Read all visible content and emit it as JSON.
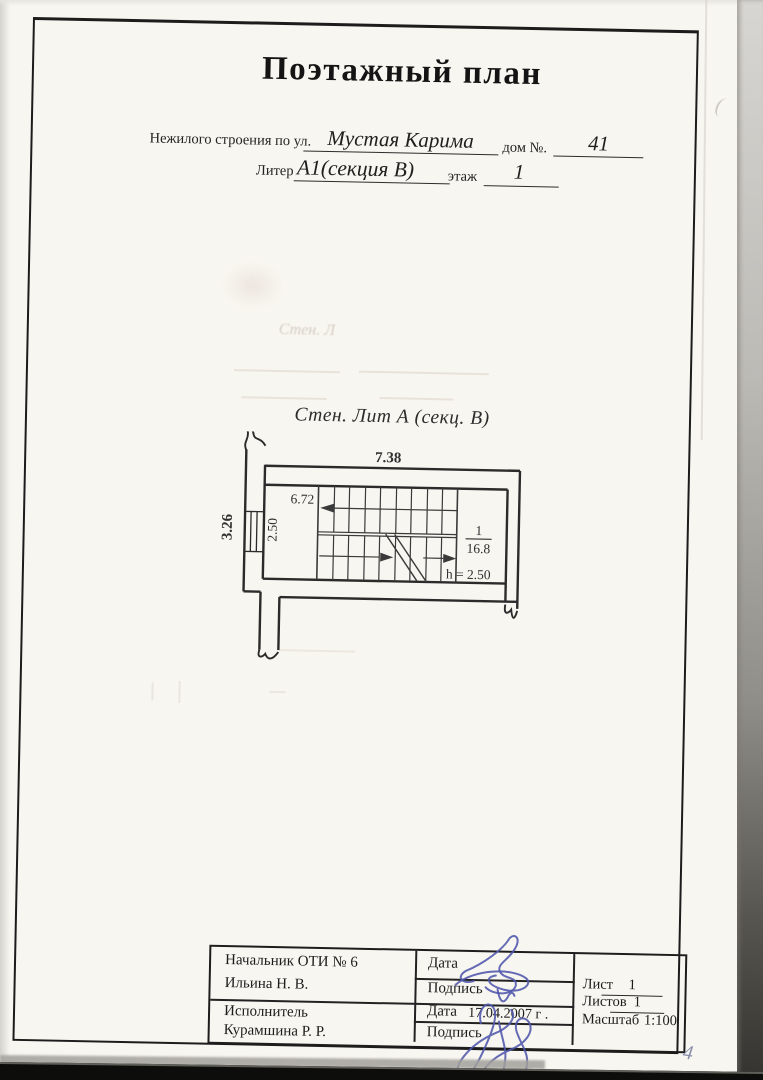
{
  "document": {
    "title": "Поэтажный план",
    "page_number": "4"
  },
  "header": {
    "building_label": "Нежилого строения по ул.",
    "street_value": "Мустая Карима",
    "house_label": "дом №.",
    "house_value": "41",
    "liter_label": "Литер",
    "liter_value": "А1(секция В)",
    "floor_label": "этаж",
    "floor_value": "1"
  },
  "plan": {
    "caption": "Стен. Лит А (секц. В)",
    "ghost_text": "Стен. Л",
    "dim_top": "7.38",
    "dim_inner_width": "6.72",
    "dim_left": "3.26",
    "dim_inner_height": "2.50",
    "room_number": "1",
    "room_area": "16.8",
    "height_note": "h = 2.50"
  },
  "stamp": {
    "row1_role": "Начальник ОТИ № 6",
    "row1_name": "Ильина Н. В.",
    "row2_role": "Исполнитель",
    "row2_name": "Курамшина Р. Р.",
    "date_label": "Дата",
    "sign_label": "Подпись",
    "date_value": "17.04.2007 г .",
    "sheet_label": "Лист",
    "sheet_value": "1",
    "sheets_label": "Листов",
    "sheets_value": "1",
    "scale_label": "Масштаб",
    "scale_value": "1:100"
  }
}
